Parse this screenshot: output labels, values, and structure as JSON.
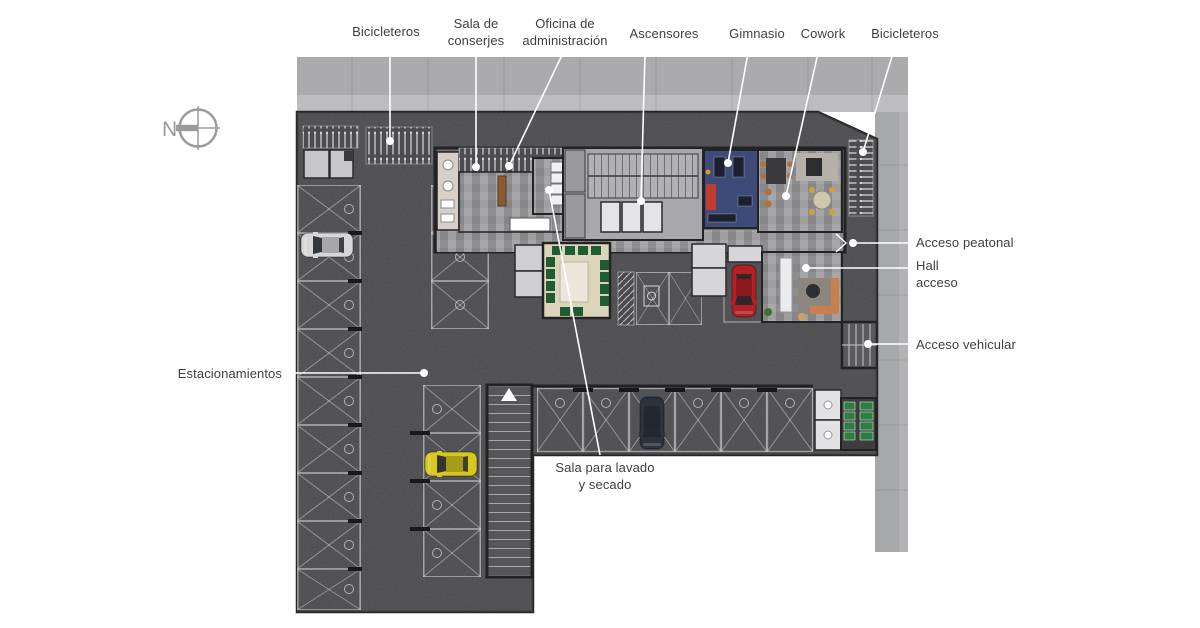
{
  "compass": {
    "letter": "N"
  },
  "labels": {
    "bicicleteros_top": "Bicicleteros",
    "sala_conserjes": "Sala de\nconserjes",
    "oficina_admin": "Oficina de\nadministración",
    "ascensores": "Ascensores",
    "gimnasio": "Gimnasio",
    "cowork": "Cowork",
    "bicicleteros_right": "Bicicleteros",
    "acceso_peatonal": "Acceso peatonal",
    "hall_acceso": "Hall\nacceso",
    "acceso_vehicular": "Acceso vehicular",
    "estacionamientos": "Estacionamientos",
    "sala_lavado": "Sala para lavado\ny secado"
  },
  "colors": {
    "annotation_text": "#3f3f3f",
    "leader_line": "#ffffff",
    "asphalt": "#47474a",
    "sidewalk_top": "#ababad",
    "sidewalk_bottom": "#bdbdbf",
    "street": "#a7a8aa",
    "gym_floor": "#3e4a78",
    "gym_mat": "#c23b30",
    "multi_room_floor": "#ddd4bc",
    "chair_green": "#1f5c31",
    "machine_green": "#2e7d43",
    "car_silver": "#d7d7d9",
    "car_yellow": "#d6c81e",
    "car_red": "#b32024",
    "car_dark": "#2a333f"
  }
}
